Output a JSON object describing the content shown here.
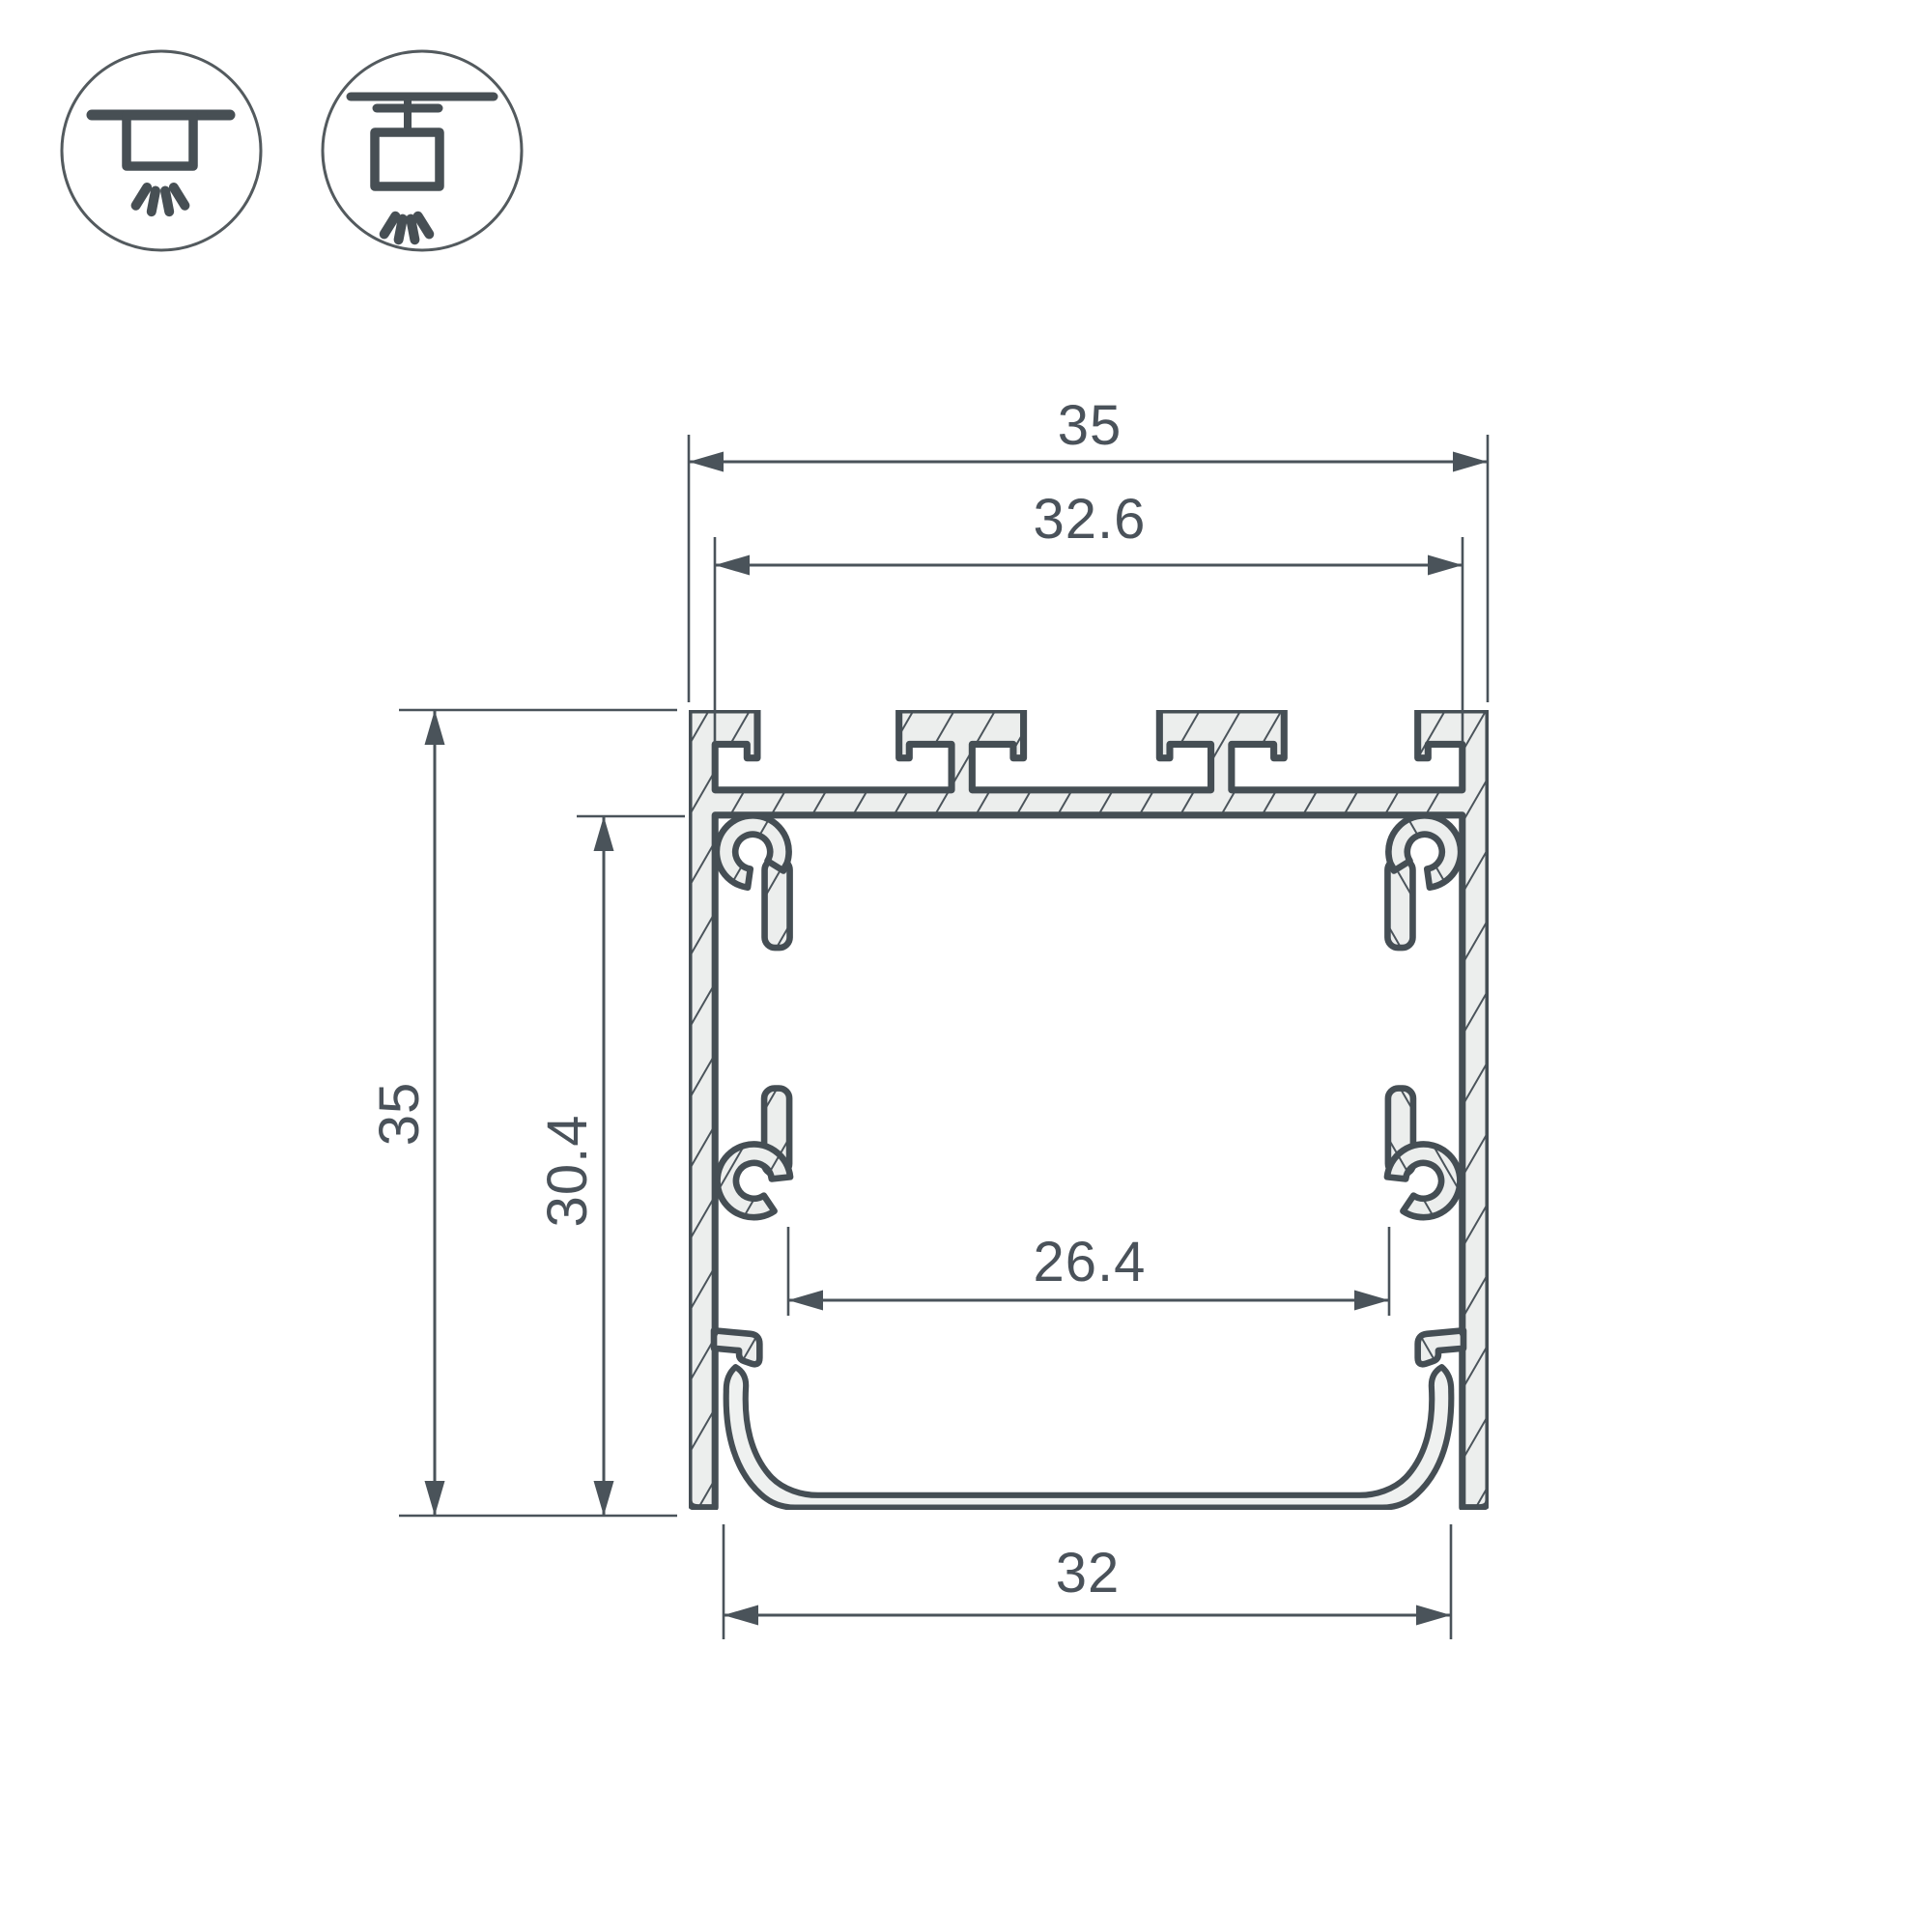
{
  "drawing": {
    "kind": "LED aluminium profile cross-section technical drawing",
    "dimensions": {
      "outer_width": "35",
      "top_inner_width": "32.6",
      "outer_height": "35",
      "inner_height": "30.4",
      "inner_width": "26.4",
      "bottom_width": "32"
    },
    "icons": {
      "first": "surface-mount-light-icon",
      "second": "pendant-mount-light-icon"
    },
    "colors": {
      "background": "#ffffff",
      "line": "#4a535a",
      "outline": "#454e54",
      "metal_fill": "#eceeed",
      "lens_fill": "#eff1f0",
      "text": "#4a525a"
    }
  }
}
